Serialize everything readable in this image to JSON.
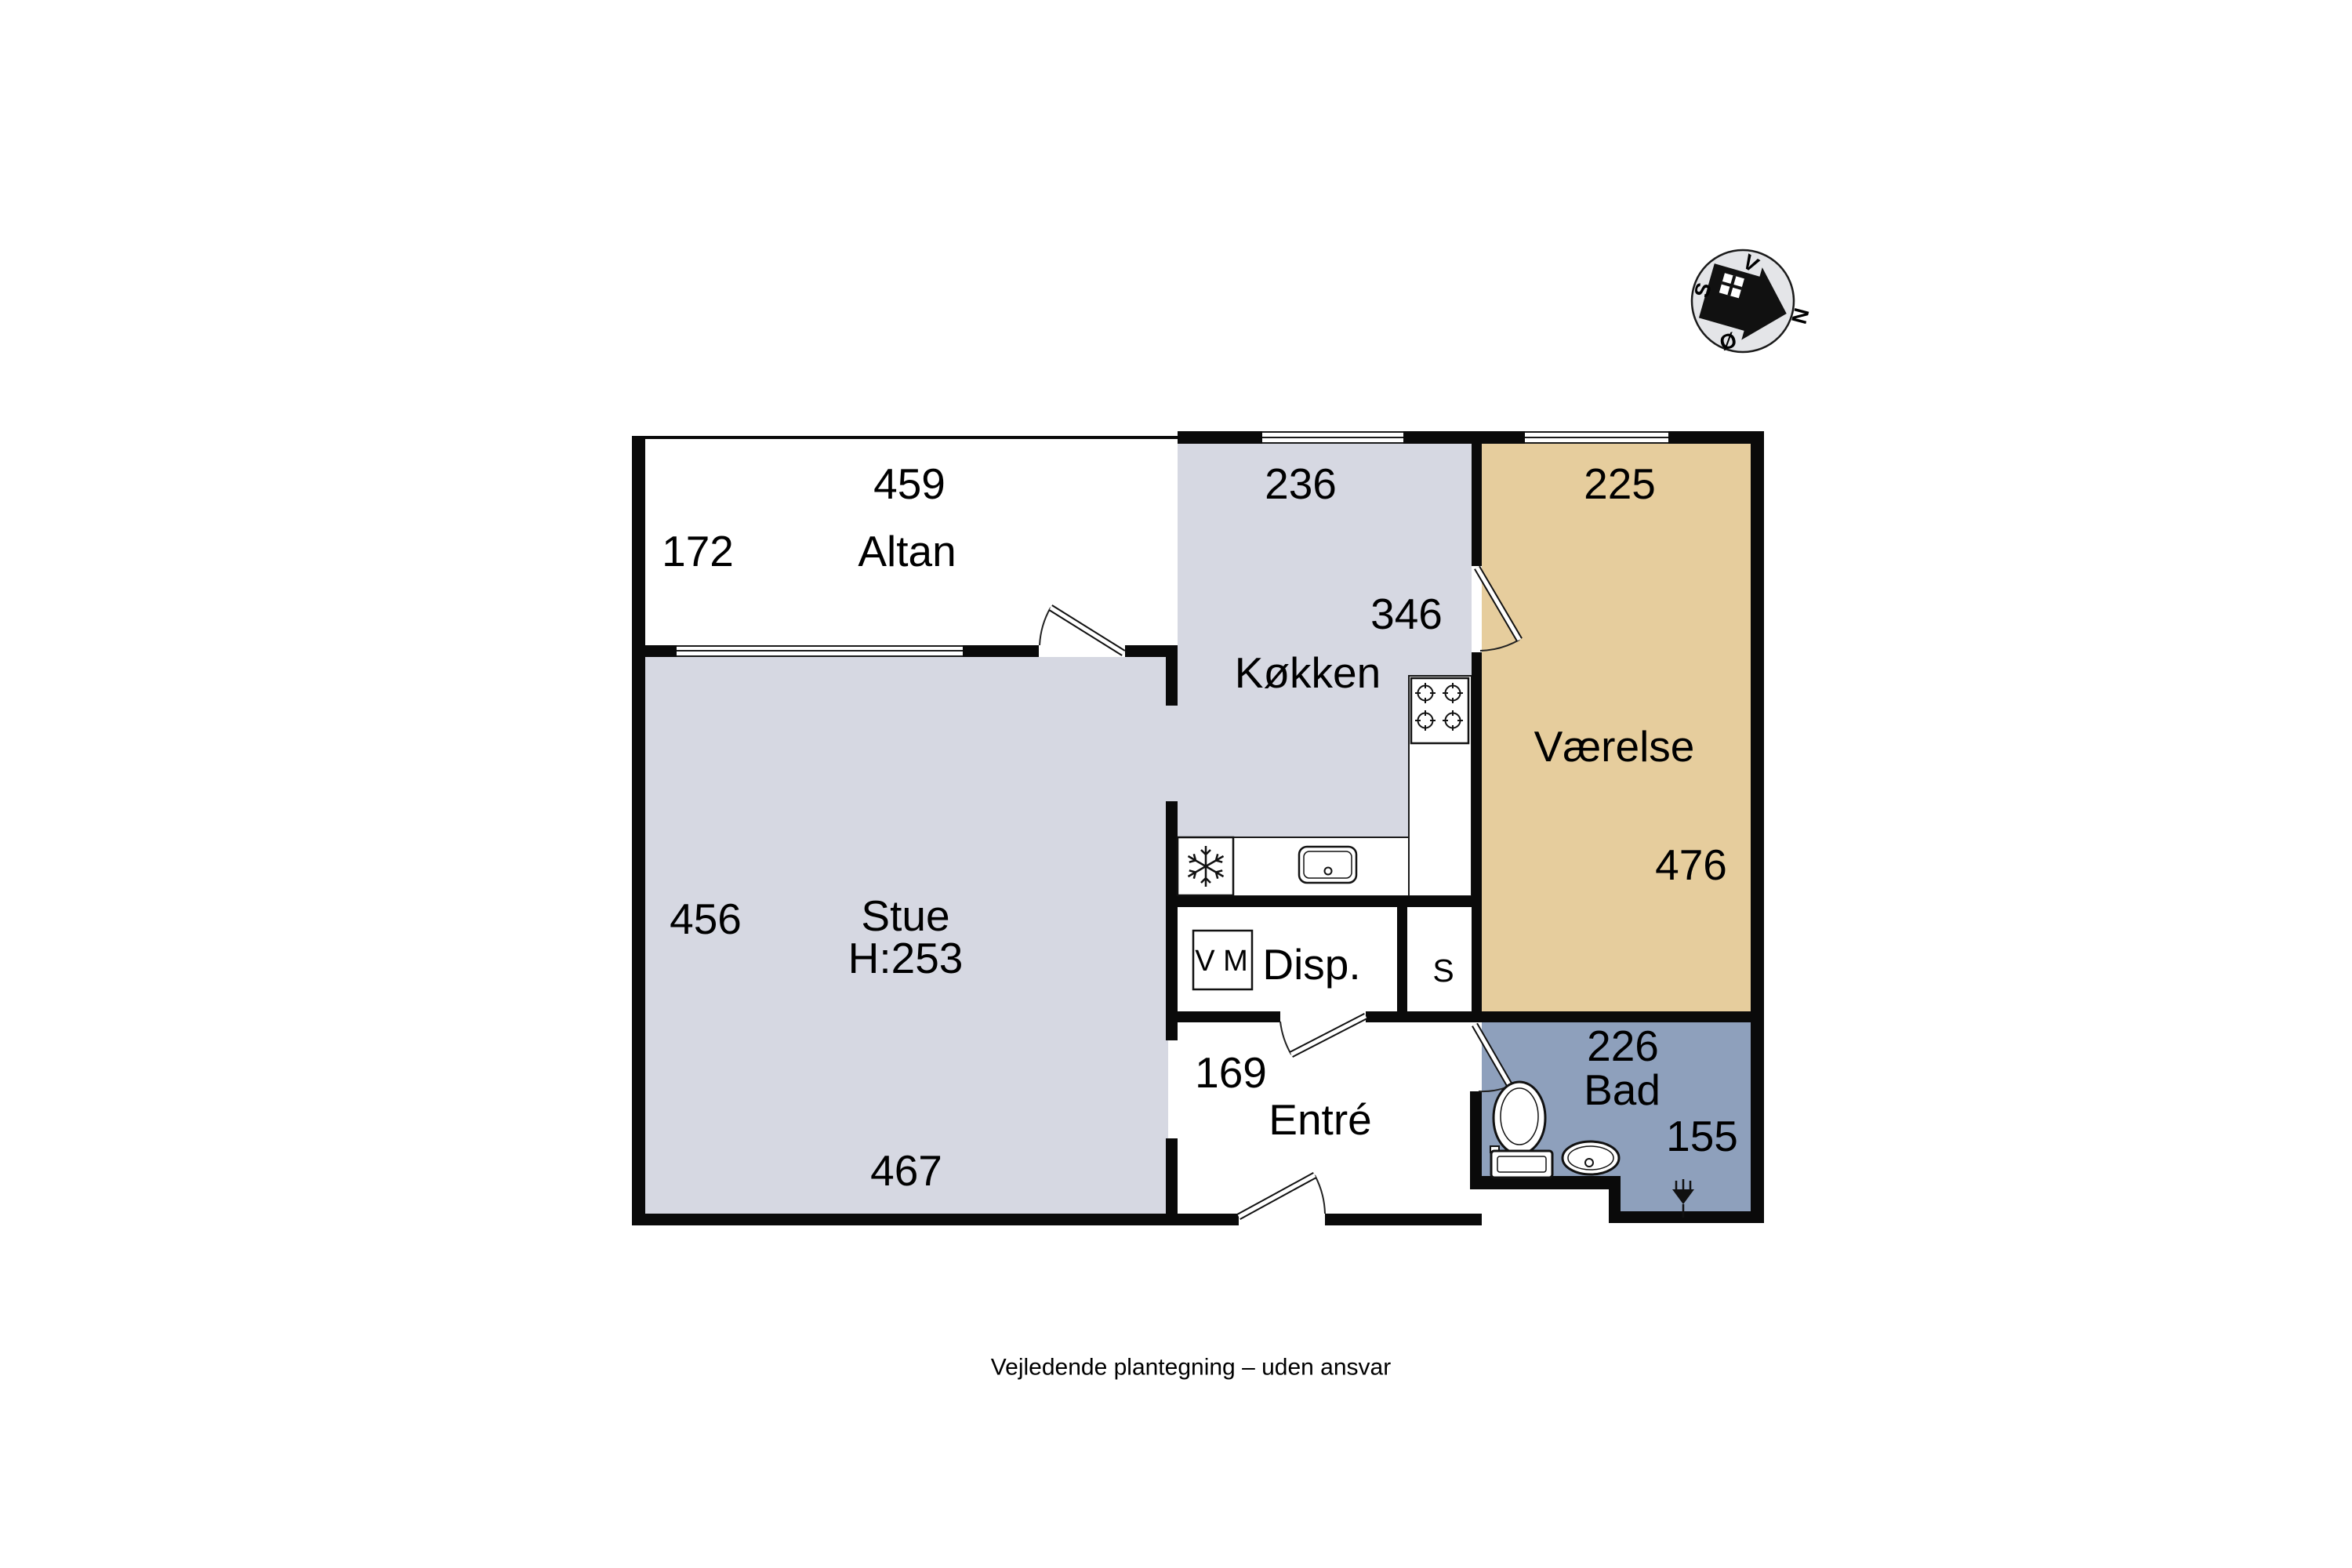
{
  "caption": "Vejledende plantegning – uden ansvar",
  "rooms": {
    "altan": {
      "name": "Altan",
      "width_cm": "459",
      "depth_cm": "172"
    },
    "stue": {
      "name": "Stue",
      "ceiling_height": "H:253",
      "left_cm": "456",
      "bottom_cm": "467"
    },
    "kokken": {
      "name": "Køkken",
      "top_cm": "236",
      "mid_cm": "346"
    },
    "vaerelse": {
      "name": "Værelse",
      "top_cm": "225",
      "right_cm": "476"
    },
    "disp": {
      "name": "Disp.",
      "appliance_label": "V M"
    },
    "skab": {
      "name": "S"
    },
    "entre": {
      "name": "Entré",
      "width_cm": "169"
    },
    "bad": {
      "name": "Bad",
      "top_cm": "226",
      "right_cm": "155"
    }
  },
  "compass": {
    "north": "N",
    "south": "S",
    "east": "Ø",
    "west": "V"
  },
  "icons": {
    "freezer": "snowflake-icon",
    "stove": "four-burner-stove-icon",
    "kitchen_sink": "sink-icon",
    "washing_machine": "washing-machine-icon",
    "toilet": "toilet-icon",
    "washbasin": "washbasin-icon",
    "floor_drain": "floor-drain-icon",
    "compass_house": "house-arrow-icon"
  },
  "colors": {
    "wall": "#0a0a0a",
    "floor_gray": "#d6d8e2",
    "room_tan": "#e6cd9d",
    "bath_blue": "#8ea0bc",
    "compass_fill": "#e4e5e8",
    "balcony_white": "#ffffff"
  }
}
